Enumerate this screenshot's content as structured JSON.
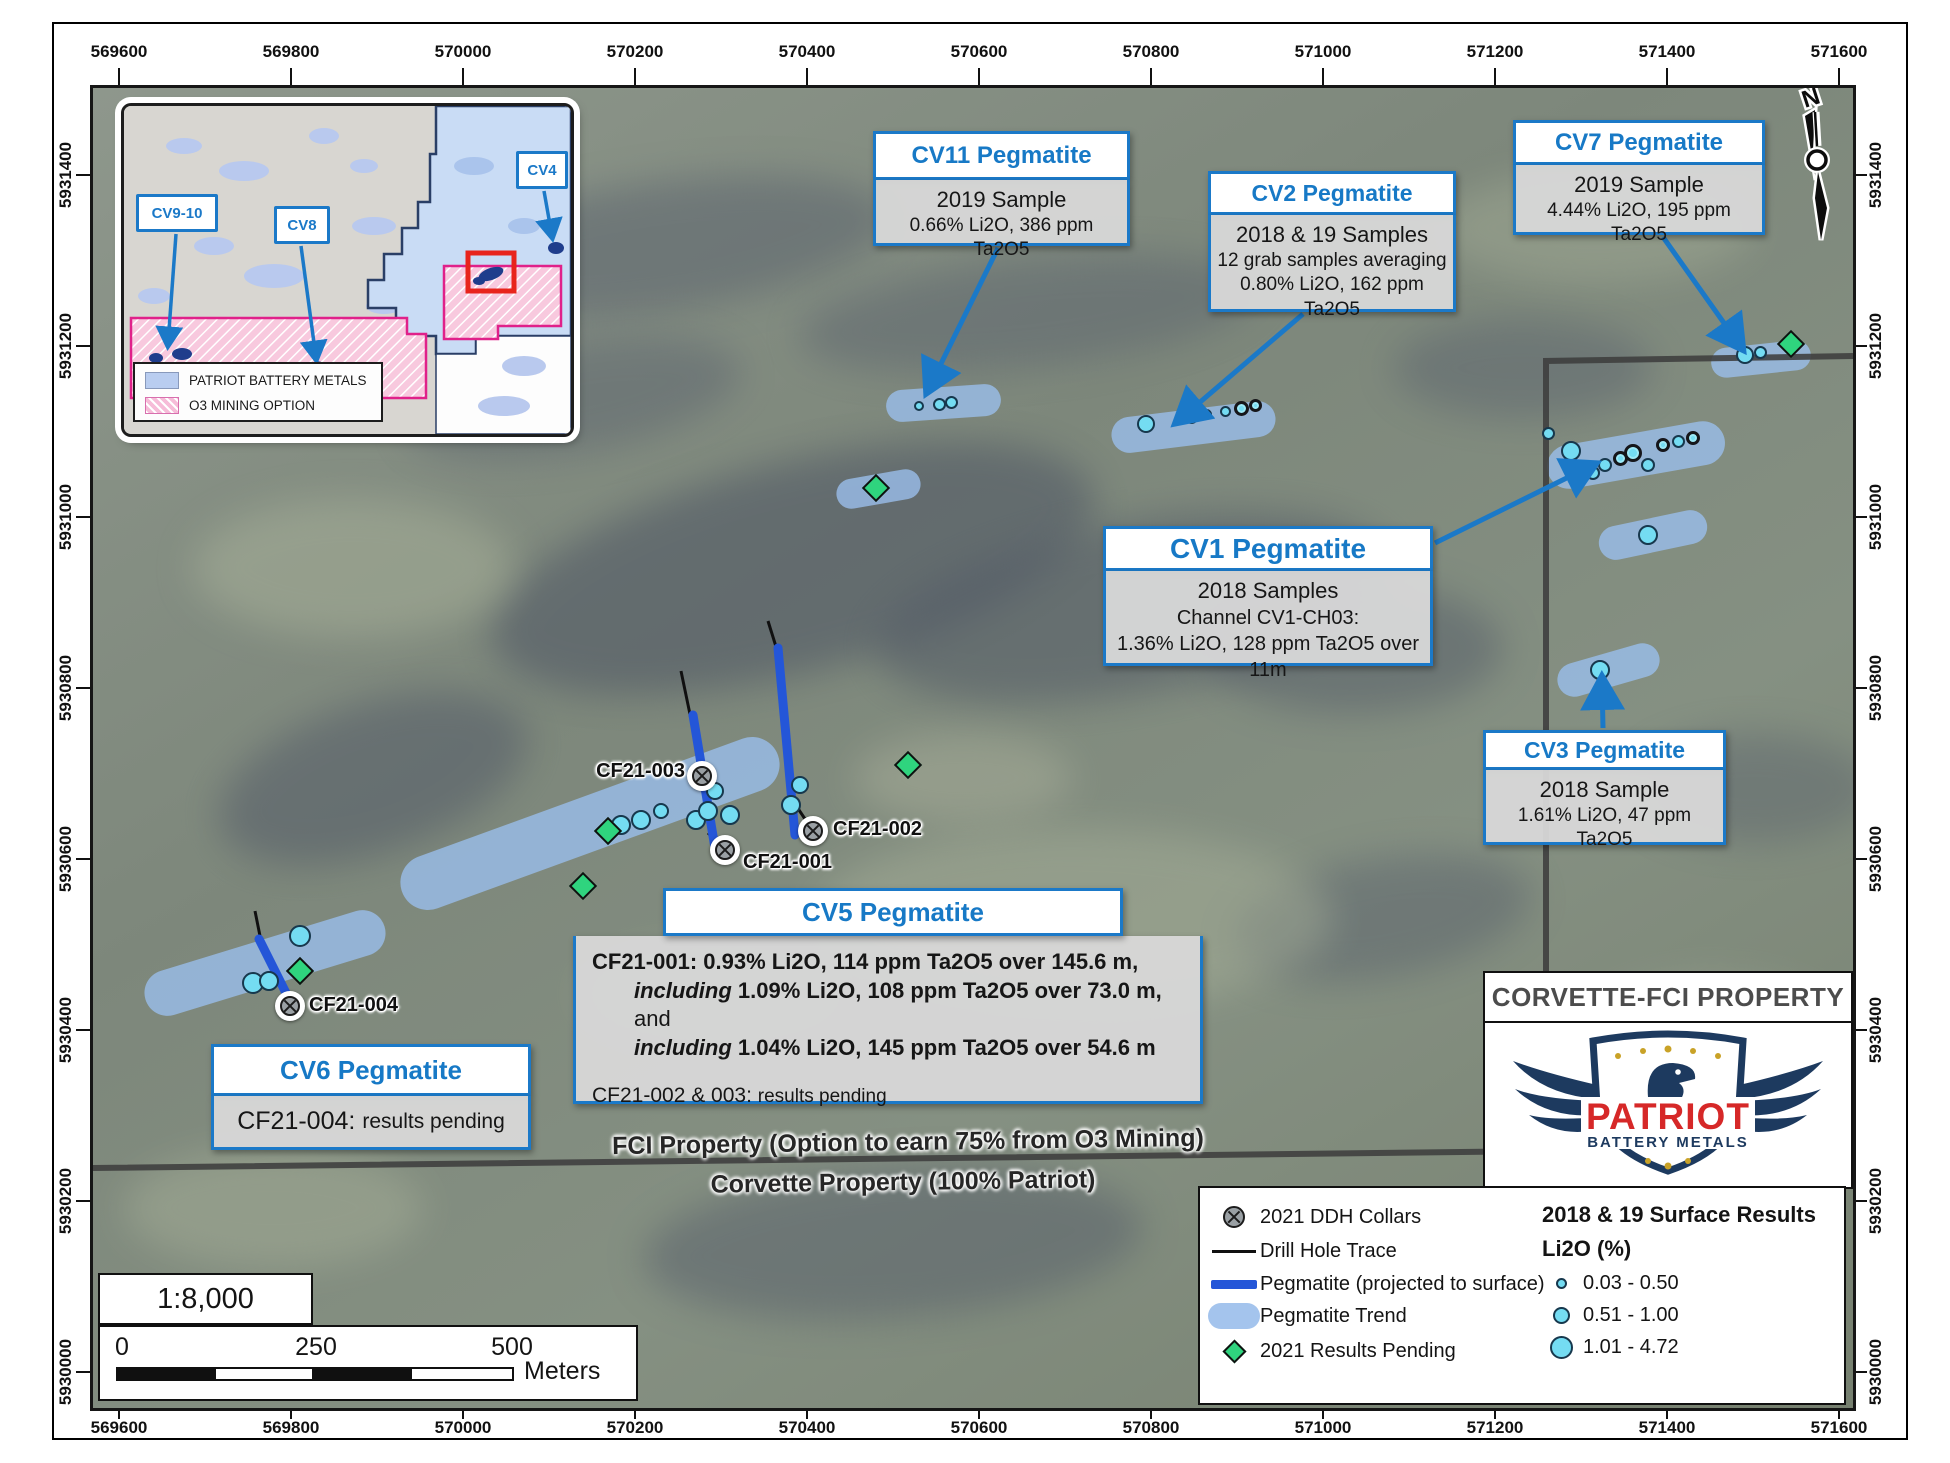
{
  "axes": {
    "x": [
      "569600",
      "569800",
      "570000",
      "570200",
      "570400",
      "570600",
      "570800",
      "571000",
      "571200",
      "571400",
      "571600"
    ],
    "y": [
      "5931400",
      "5931200",
      "5931000",
      "5930800",
      "5930600",
      "5930400",
      "5930200",
      "5930000"
    ]
  },
  "inset": {
    "labels": [
      "CV9-10",
      "CV8",
      "CV4"
    ],
    "legend": [
      "PATRIOT BATTERY METALS",
      "O3 MINING OPTION"
    ]
  },
  "callouts": {
    "cv11": {
      "title": "CV11 Pegmatite",
      "line1": "2019 Sample",
      "line2": "0.66% Li2O, 386 ppm Ta2O5"
    },
    "cv2": {
      "title": "CV2 Pegmatite",
      "line1": "2018 & 19 Samples",
      "line2": "12 grab samples averaging",
      "line3": "0.80% Li2O, 162 ppm Ta2O5"
    },
    "cv7": {
      "title": "CV7 Pegmatite",
      "line1": "2019 Sample",
      "line2": "4.44% Li2O, 195 ppm Ta2O5"
    },
    "cv1": {
      "title": "CV1 Pegmatite",
      "line1": "2018 Samples",
      "line2": "Channel CV1-CH03:",
      "line3": "1.36% Li2O, 128 ppm Ta2O5 over 11m"
    },
    "cv3": {
      "title": "CV3 Pegmatite",
      "line1": "2018 Sample",
      "line2": "1.61% Li2O, 47 ppm Ta2O5"
    },
    "cv5": {
      "title": "CV5 Pegmatite",
      "l1": "CF21-001: 0.93% Li2O, 114 ppm Ta2O5 over 145.6 m,",
      "l2i": "including",
      "l2b": "1.09% Li2O, 108 ppm Ta2O5 over 73.0 m,",
      "l2s": "and",
      "l3i": "including",
      "l3b": "1.04% Li2O, 145 ppm Ta2O5 over 54.6 m",
      "l4a": "CF21-002 & 003:",
      "l4b": "results pending"
    },
    "cv6": {
      "title": "CV6 Pegmatite",
      "bold": "CF21-004:",
      "rest": "results pending"
    }
  },
  "collars": {
    "c1": "CF21-001",
    "c2": "CF21-002",
    "c3": "CF21-003",
    "c4": "CF21-004"
  },
  "boundary": {
    "fci": "FCI Property (Option to earn 75% from O3 Mining)",
    "corvette": "Corvette Property (100% Patriot)"
  },
  "legend": {
    "items": [
      "2021 DDH Collars",
      "Drill Hole Trace",
      "Pegmatite (projected to surface)",
      "Pegmatite Trend",
      "2021 Results Pending"
    ],
    "surface_title": "2018 & 19 Surface Results",
    "surface_subtitle": "Li2O (%)",
    "ranges": [
      "0.03 - 0.50",
      "0.51 - 1.00",
      "1.01 - 4.72"
    ]
  },
  "title_box": {
    "title": "CORVETTE-FCI PROPERTY"
  },
  "logo": {
    "brand": "PATRIOT",
    "sub": "BATTERY METALS"
  },
  "scale": {
    "ratio": "1:8,000",
    "t0": "0",
    "t250": "250",
    "t500": "500",
    "unit": "Meters"
  },
  "north": {
    "n": "N"
  },
  "colors": {
    "accent_blue": "#1b79c8",
    "pegmatite_blue": "#2456d8",
    "trend_blue": "#a9c7ec",
    "sample_cyan": "#74dcf2",
    "pending_green": "#2fd47e",
    "brand_red": "#d62828",
    "brand_navy": "#1d3a5f"
  }
}
